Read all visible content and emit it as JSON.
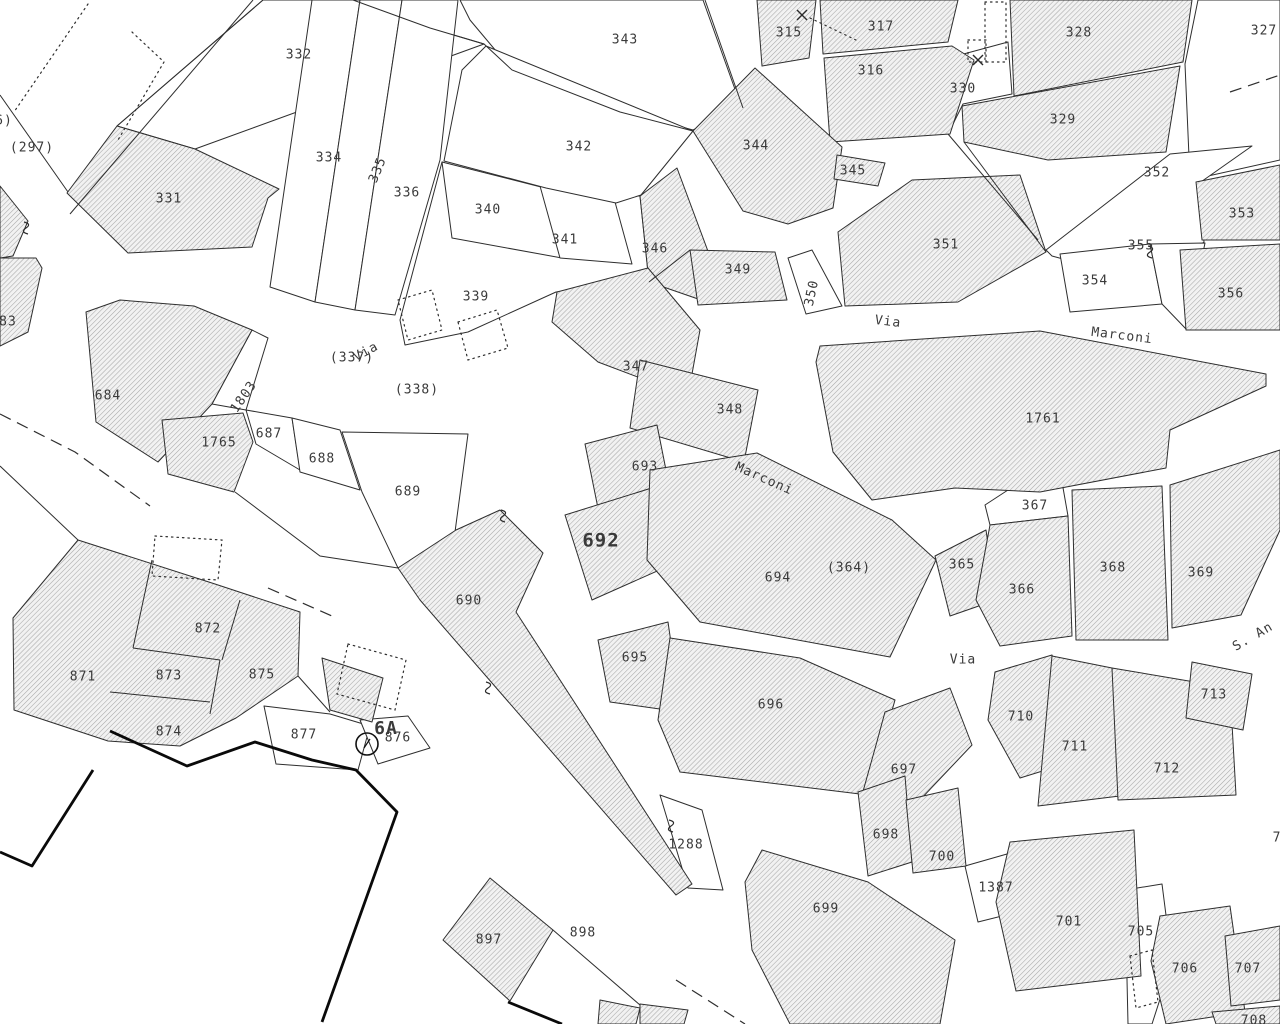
{
  "map": {
    "type": "cadastral-parcel-map",
    "canvas": {
      "width": 1280,
      "height": 1024,
      "bg": "#ffffff",
      "line_color": "#2e2e2e",
      "hatch_line_color": "#a8a8a8",
      "label_color": "#3a3a3a",
      "label_size": 13
    },
    "street_labels": [
      {
        "text": "Via",
        "x": 888,
        "y": 322,
        "rot": 7
      },
      {
        "text": "Marconi",
        "x": 1122,
        "y": 336,
        "rot": 7
      },
      {
        "text": "Via",
        "x": 366,
        "y": 352,
        "rot": -28
      },
      {
        "text": "Marconi",
        "x": 764,
        "y": 479,
        "rot": 24
      },
      {
        "text": "Via",
        "x": 963,
        "y": 660,
        "rot": 0
      },
      {
        "text": "S. An",
        "x": 1253,
        "y": 637,
        "rot": -30
      }
    ],
    "parcel_labels": [
      {
        "text": "6)",
        "x": 4,
        "y": 121
      },
      {
        "text": "(297)",
        "x": 32,
        "y": 148
      },
      {
        "text": "332",
        "x": 299,
        "y": 55
      },
      {
        "text": "343",
        "x": 625,
        "y": 40
      },
      {
        "text": "334",
        "x": 329,
        "y": 158
      },
      {
        "text": "335",
        "x": 378,
        "y": 170,
        "rot": -68
      },
      {
        "text": "336",
        "x": 407,
        "y": 193
      },
      {
        "text": "342",
        "x": 579,
        "y": 147
      },
      {
        "text": "340",
        "x": 488,
        "y": 210
      },
      {
        "text": "341",
        "x": 565,
        "y": 240
      },
      {
        "text": "331",
        "x": 169,
        "y": 199
      },
      {
        "text": "344",
        "x": 756,
        "y": 146
      },
      {
        "text": "345",
        "x": 853,
        "y": 171
      },
      {
        "text": "315",
        "x": 789,
        "y": 33
      },
      {
        "text": "317",
        "x": 881,
        "y": 27
      },
      {
        "text": "316",
        "x": 871,
        "y": 71
      },
      {
        "text": "330",
        "x": 963,
        "y": 89
      },
      {
        "text": "328",
        "x": 1079,
        "y": 33
      },
      {
        "text": "327",
        "x": 1264,
        "y": 31
      },
      {
        "text": "329",
        "x": 1063,
        "y": 120
      },
      {
        "text": "352",
        "x": 1157,
        "y": 173
      },
      {
        "text": "353",
        "x": 1242,
        "y": 214
      },
      {
        "text": "355",
        "x": 1141,
        "y": 246
      },
      {
        "text": "354",
        "x": 1095,
        "y": 281
      },
      {
        "text": "356",
        "x": 1231,
        "y": 294
      },
      {
        "text": "351",
        "x": 946,
        "y": 245
      },
      {
        "text": "346",
        "x": 655,
        "y": 249
      },
      {
        "text": "349",
        "x": 738,
        "y": 270
      },
      {
        "text": "350",
        "x": 812,
        "y": 293,
        "rot": -78
      },
      {
        "text": "339",
        "x": 476,
        "y": 297
      },
      {
        "text": "(337)",
        "x": 352,
        "y": 358
      },
      {
        "text": "(338)",
        "x": 417,
        "y": 390
      },
      {
        "text": "347",
        "x": 636,
        "y": 367
      },
      {
        "text": "348",
        "x": 730,
        "y": 410
      },
      {
        "text": "1761",
        "x": 1043,
        "y": 419
      },
      {
        "text": "83",
        "x": 8,
        "y": 322
      },
      {
        "text": "684",
        "x": 108,
        "y": 396
      },
      {
        "text": "1803",
        "x": 244,
        "y": 397,
        "rot": -55
      },
      {
        "text": "1765",
        "x": 219,
        "y": 443
      },
      {
        "text": "687",
        "x": 269,
        "y": 434
      },
      {
        "text": "688",
        "x": 322,
        "y": 459
      },
      {
        "text": "689",
        "x": 408,
        "y": 492
      },
      {
        "text": "693",
        "x": 645,
        "y": 467
      },
      {
        "text": "692",
        "x": 601,
        "y": 541,
        "bold": true,
        "size": 19
      },
      {
        "text": "694",
        "x": 778,
        "y": 578
      },
      {
        "text": "(364)",
        "x": 849,
        "y": 568
      },
      {
        "text": "365",
        "x": 962,
        "y": 565
      },
      {
        "text": "367",
        "x": 1035,
        "y": 506
      },
      {
        "text": "366",
        "x": 1022,
        "y": 590
      },
      {
        "text": "368",
        "x": 1113,
        "y": 568
      },
      {
        "text": "369",
        "x": 1201,
        "y": 573
      },
      {
        "text": "690",
        "x": 469,
        "y": 601
      },
      {
        "text": "695",
        "x": 635,
        "y": 658
      },
      {
        "text": "696",
        "x": 771,
        "y": 705
      },
      {
        "text": "710",
        "x": 1021,
        "y": 717
      },
      {
        "text": "711",
        "x": 1075,
        "y": 747
      },
      {
        "text": "713",
        "x": 1214,
        "y": 695
      },
      {
        "text": "712",
        "x": 1167,
        "y": 769
      },
      {
        "text": "871",
        "x": 83,
        "y": 677
      },
      {
        "text": "872",
        "x": 208,
        "y": 629
      },
      {
        "text": "873",
        "x": 169,
        "y": 676
      },
      {
        "text": "875",
        "x": 262,
        "y": 675
      },
      {
        "text": "874",
        "x": 169,
        "y": 732
      },
      {
        "text": "877",
        "x": 304,
        "y": 735
      },
      {
        "text": "6A",
        "x": 386,
        "y": 729,
        "bold": true,
        "size": 18
      },
      {
        "text": "876",
        "x": 398,
        "y": 738,
        "color": "#6a6a6a"
      },
      {
        "text": "697",
        "x": 904,
        "y": 770
      },
      {
        "text": "1288",
        "x": 686,
        "y": 845
      },
      {
        "text": "698",
        "x": 886,
        "y": 835
      },
      {
        "text": "700",
        "x": 942,
        "y": 857
      },
      {
        "text": "1387",
        "x": 996,
        "y": 888
      },
      {
        "text": "699",
        "x": 826,
        "y": 909
      },
      {
        "text": "701",
        "x": 1069,
        "y": 922
      },
      {
        "text": "705",
        "x": 1141,
        "y": 932
      },
      {
        "text": "706",
        "x": 1185,
        "y": 969
      },
      {
        "text": "707",
        "x": 1248,
        "y": 969
      },
      {
        "text": "708",
        "x": 1254,
        "y": 1021
      },
      {
        "text": "897",
        "x": 489,
        "y": 940
      },
      {
        "text": "898",
        "x": 583,
        "y": 933
      },
      {
        "text": "7",
        "x": 1277,
        "y": 838
      }
    ],
    "hatched_parcels": [
      "117,126 195,149 279,189 268,198 252,247 128,253 67,193",
      "0,186 28,221 13,256 0,258",
      "0,258 36,258 42,268 28,332 0,346",
      "86,312 120,300 194,306 252,330 212,404 158,462 96,422",
      "162,420 243,413 253,442 234,492 168,474",
      "757,0 816,0 809,58 762,66",
      "820,0 958,0 948,42 823,54",
      "824,58 952,46 974,60 950,134 830,142",
      "1010,0 1192,0 1183,62 1014,96",
      "962,106 1180,66 1166,152 1048,160 964,142",
      "755,68 842,147 833,208 788,224 743,211 693,131",
      "837,155 885,163 878,186 834,179",
      "640,196 677,168 712,262 701,300 649,282",
      "690,250 775,252 787,300 698,305",
      "838,232 912,180 1020,175 1046,252 958,302 845,306",
      "1196,182 1280,165 1280,240 1202,240",
      "1180,250 1280,244 1280,330 1186,330",
      "820,346 1040,331 1266,374 1266,386 1170,430 1166,468 1040,492 955,488 872,500 833,452 816,362",
      "557,292 648,268 700,330 688,396 598,362 552,322",
      "640,360 758,390 744,462 630,428",
      "585,444 657,425 673,505 602,528",
      "565,515 658,486 682,560 592,600",
      "398,568 456,530 500,510 543,553 516,612 692,884 676,895 420,600",
      "650,470 757,453 892,520 936,560 890,657 700,622 647,560",
      "935,556 986,530 996,600 950,616",
      "990,525 1068,516 1072,636 1000,646 976,600",
      "1072,490 1162,486 1168,640 1076,640",
      "1170,485 1280,450 1280,530 1241,615 1172,628",
      "78,540 215,584 300,612 298,676 236,718 180,746 108,741 14,710 13,618",
      "322,658 383,678 372,722 330,710",
      "598,640 668,622 681,712 610,702",
      "670,638 800,658 895,700 868,795 680,772 658,720",
      "885,712 950,688 972,745 918,802 862,795 876,745",
      "858,792 905,776 912,862 868,876",
      "906,800 958,788 966,866 913,873",
      "762,850 868,882 955,940 940,1024 790,1024 752,950 745,882",
      "1010,842 1134,830 1141,976 1016,991 996,902",
      "1160,916 1230,906 1245,1012 1166,1024 1151,961",
      "1225,936 1280,926 1280,1000 1231,1006",
      "1212,1012 1280,1006 1280,1024 1216,1024",
      "995,672 1052,655 1078,760 1020,778 988,720",
      "1052,656 1112,668 1128,795 1038,806",
      "1112,668 1230,688 1236,795 1118,800",
      "1192,662 1252,674 1243,730 1186,718",
      "490,878 553,930 510,1001 443,940",
      "600,1000 640,1008 636,1024 598,1024",
      "640,1004 688,1010 684,1024 640,1024"
    ],
    "white_parcels": [
      "263,0 353,0 430,28 484,44 195,149 117,126",
      "460,0 703,0 741,106 693,130 600,105 512,70 470,20",
      "312,0 360,0 315,302 270,287",
      "360,0 402,0 355,310 315,302",
      "402,0 458,0 440,160 395,315 355,310",
      "400,320 442,162 540,195 640,196 649,282 556,292 468,332 405,345",
      "442,162 545,188 562,258 452,238",
      "540,186 615,202 632,264 560,258",
      "486,46 693,131 641,195 616,203 546,188 444,161 462,70",
      "788,258 812,250 842,306 806,314",
      "934,62 1008,42 1012,94 963,104 948,134 936,120",
      "1198,0 1280,0 1280,160 1190,180 1185,64",
      "1046,250 1170,154 1252,146 1198,184 1204,242 1148,282 1052,256",
      "1060,254 1150,244 1162,304 1070,312",
      "1150,244 1205,243 1187,330 1162,304",
      "212,404 252,330 268,338 246,410",
      "246,410 292,418 300,470 256,444",
      "292,418 340,430 360,490 300,472",
      "342,432 468,434 455,532 398,568 362,492",
      "1008,490 1062,482 1068,516 990,525 985,505",
      "264,706 330,714 370,726 358,770 276,764",
      "360,720 408,716 430,748 378,764",
      "660,795 702,810 723,890 688,888",
      "965,866 1014,852 1026,910 978,922",
      "1125,890 1162,884 1172,962 1152,1024 1128,1024"
    ],
    "boundary_lines": [
      "253,0 70,214",
      "263,0 117,126",
      "0,95 68,192",
      "705,0 743,108",
      "353,0 430,28 484,44 512,70 620,112 693,131",
      "152,560 133,648",
      "133,648 220,660",
      "220,660 210,714",
      "110,692 210,702",
      "240,600 222,660",
      "235,492 320,556 398,568",
      "0,466 78,540",
      "948,134 1038,240",
      "964,142 1046,252",
      "649,282 690,250",
      "553,930 640,1005",
      "298,676 330,712"
    ],
    "dotted_lines": [
      "88,4 14,112",
      "132,32 164,62",
      "164,62 118,140",
      "810,18 856,40",
      "398,300 432,290 442,330 408,340 398,300",
      "458,322 497,310 508,348 468,360 458,322",
      "985,2 1006,2 1006,62 985,62 985,2",
      "968,40 986,40 986,62 968,62 968,40",
      "155,536 222,540 218,580 152,576 155,536",
      "348,644 406,660 395,710 337,694 348,644",
      "1130,956 1152,950 1158,1002 1136,1008 1130,956"
    ],
    "dashed_lines": [
      "0,414 75,452 150,506",
      "268,588 332,616",
      "676,980 745,1024",
      "1230,92 1280,75"
    ],
    "thick_lines": [
      "110,731 187,766 255,742 312,760 356,770 397,812 322,1022",
      "93,770 32,866 0,852",
      "508,1002 562,1024"
    ],
    "symbols": {
      "survey_circles": [
        {
          "x": 367,
          "y": 744,
          "r": 11
        }
      ],
      "crosses": [
        {
          "x": 802,
          "y": 15
        },
        {
          "x": 978,
          "y": 60
        }
      ],
      "line_break_curls": [
        {
          "x": 28,
          "y": 228
        },
        {
          "x": 505,
          "y": 516
        },
        {
          "x": 490,
          "y": 688
        },
        {
          "x": 673,
          "y": 826
        },
        {
          "x": 1152,
          "y": 252
        }
      ]
    }
  }
}
